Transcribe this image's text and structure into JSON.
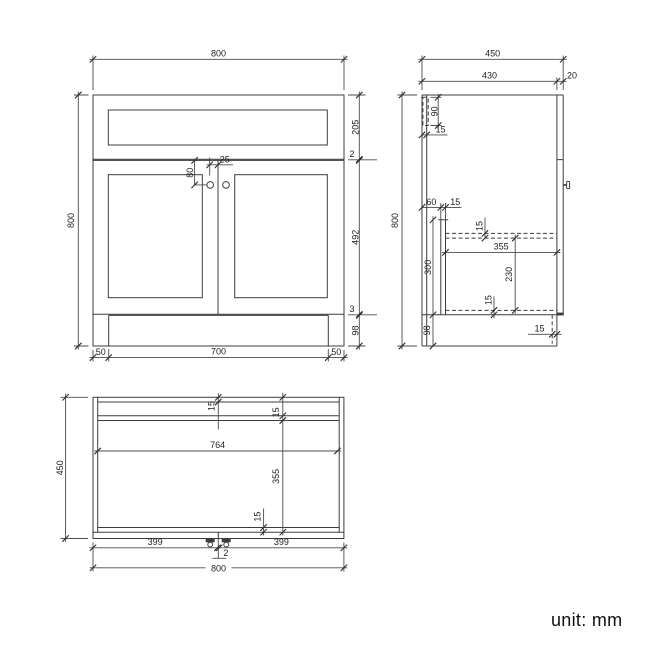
{
  "footer": {
    "unit_note": "unit: mm"
  },
  "front_view": {
    "width_top": "800",
    "height_left": "800",
    "dim_top_section": "205",
    "dim_gap_top": "2",
    "dim_door_height": "492",
    "dim_gap_bottom": "3",
    "dim_plinth_height": "98",
    "dim_plinth_inset_left": "50",
    "dim_plinth_width": "700",
    "dim_plinth_inset_right": "50",
    "dim_handle_from_top": "80",
    "dim_handle_from_center": "25"
  },
  "side_view": {
    "depth_total": "450",
    "depth_body": "430",
    "door_thickness": "20",
    "height_left": "800",
    "back_rail_height": "90",
    "back_panel_thickness": "15",
    "partition_offset": "60",
    "partition_thickness": "15",
    "partition_height": "300",
    "shelf_thickness": "15",
    "interior_depth": "355",
    "shelf_to_base": "230",
    "base_thickness": "15",
    "plinth_height": "98",
    "plinth_recess": "15"
  },
  "top_view": {
    "depth_left": "450",
    "back_panel_thickness": "15",
    "partition_thickness": "15",
    "interior_width": "764",
    "interior_depth": "355",
    "front_rail_thickness": "15",
    "door_width_left": "399",
    "door_width_right": "399",
    "door_gap": "2",
    "width_bottom": "800"
  }
}
